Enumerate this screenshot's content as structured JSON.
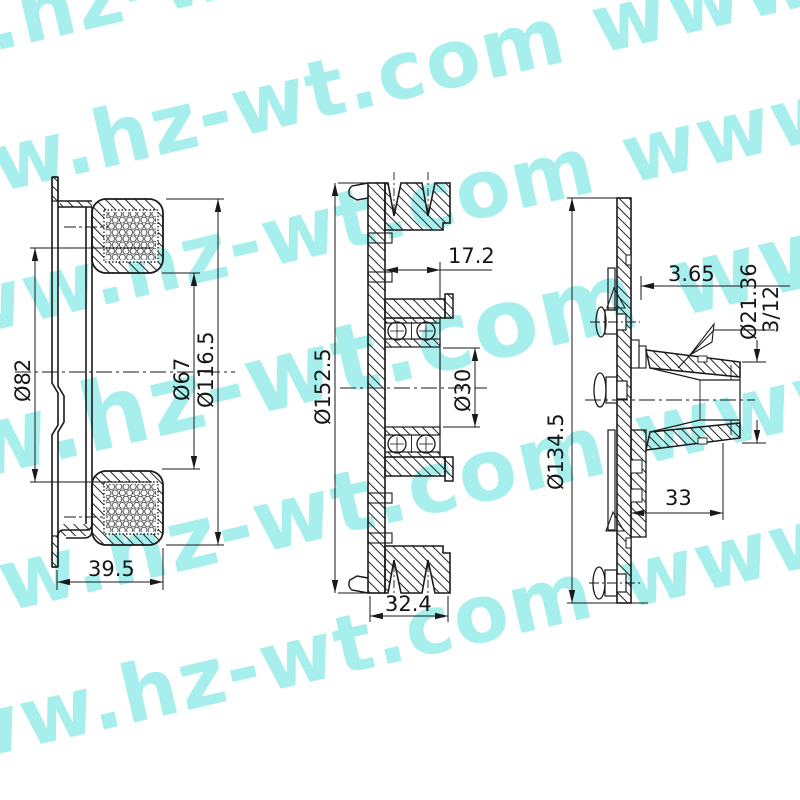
{
  "watermark": {
    "text": "www.hz-wt.com",
    "color": "#a6efed",
    "lines": [
      "www.hz-wt.com www.hz-wt.com",
      "www.hz-wt.com www.hz-wt.com",
      "www.hz-wt.com www.hz-wt.com",
      "www.hz-wt.com www.hz-wt.com",
      "www.hz-wt.com www.hz-wt.com",
      "www.hz-wt.com www.hz-wt.com"
    ]
  },
  "drawing": {
    "line_color": "#1a1a1a",
    "views": {
      "left": {
        "name": "coil-housing-section",
        "dimensions": {
          "dia82": "Ø82",
          "dia67": "Ø67",
          "dia116_5": "Ø116.5",
          "width39_5": "39.5"
        }
      },
      "middle": {
        "name": "pulley-section",
        "dimensions": {
          "dia152_5": "Ø152.5",
          "offset17_2": "17.2",
          "dia30": "Ø30",
          "width32_4": "32.4"
        }
      },
      "right": {
        "name": "hub-armature-section",
        "dimensions": {
          "dia134_5": "Ø134.5",
          "gap3_65": "3.65",
          "dia21_36": "Ø21.36",
          "spline3_12": "3/12",
          "len33": "33"
        }
      }
    }
  }
}
